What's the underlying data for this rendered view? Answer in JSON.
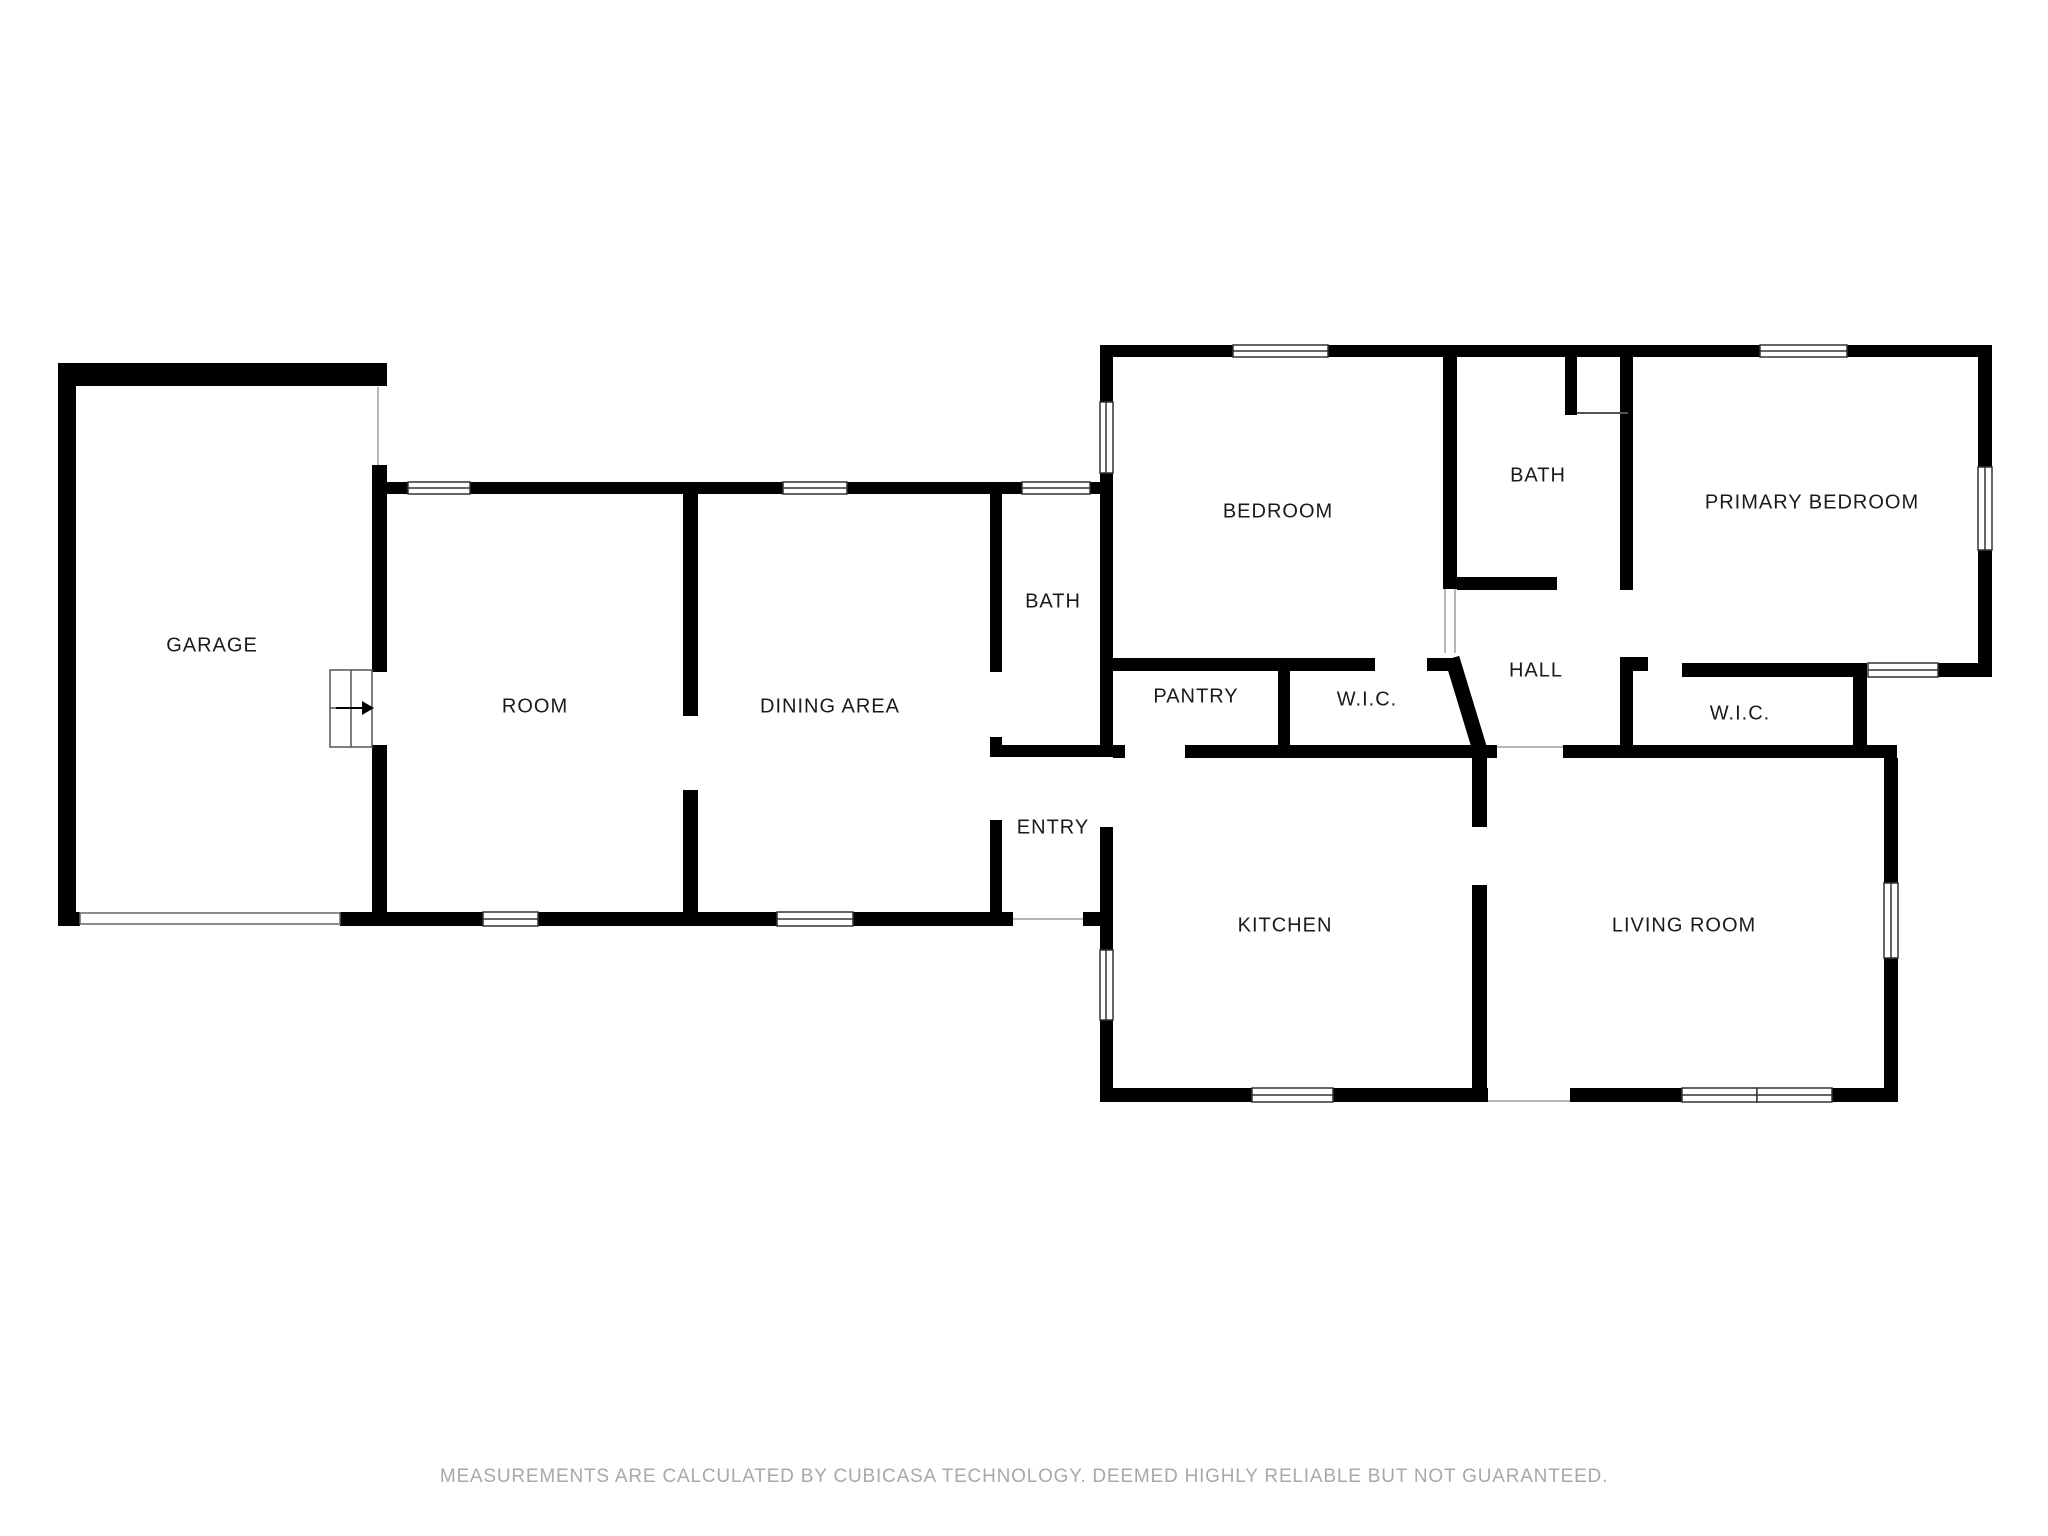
{
  "plan": {
    "wall_color": "#000000",
    "background_color": "#ffffff",
    "label_color": "#1a1a1a",
    "rooms": [
      {
        "label": "GARAGE"
      },
      {
        "label": "ROOM"
      },
      {
        "label": "DINING AREA"
      },
      {
        "label": "BATH"
      },
      {
        "label": "ENTRY"
      },
      {
        "label": "BEDROOM"
      },
      {
        "label": "BATH"
      },
      {
        "label": "PRIMARY BEDROOM"
      },
      {
        "label": "PANTRY"
      },
      {
        "label": "W.I.C."
      },
      {
        "label": "HALL"
      },
      {
        "label": "W.I.C."
      },
      {
        "label": "KITCHEN"
      },
      {
        "label": "LIVING ROOM"
      }
    ],
    "icons": {
      "stairs_arrow": "stairs-direction-arrow"
    }
  },
  "disclaimer": {
    "text": "MEASUREMENTS ARE CALCULATED BY CUBICASA TECHNOLOGY. DEEMED HIGHLY RELIABLE BUT NOT GUARANTEED.",
    "color": "#a8a8a8"
  }
}
